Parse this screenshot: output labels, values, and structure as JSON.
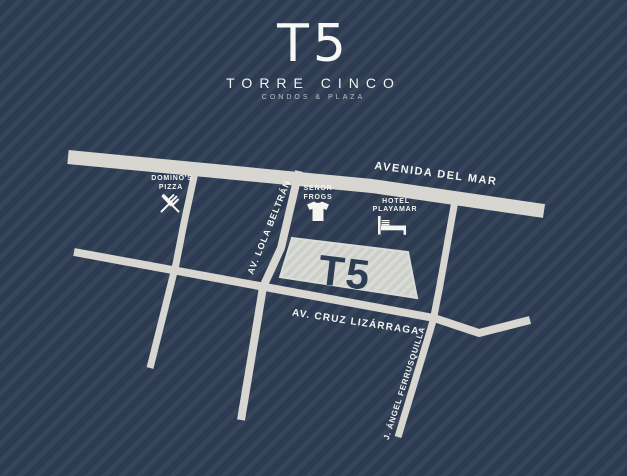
{
  "logo": {
    "mark": "T5",
    "name": "TORRE CINCO",
    "tagline": "CONDOS & PLAZA"
  },
  "map": {
    "building": {
      "label": "T5"
    },
    "streets": {
      "avenida_del_mar": "AVENIDA DEL MAR",
      "lola_beltran": "AV. LOLA BELTRÁN",
      "cruz_lizarraga": "AV. CRUZ LIZÁRRAGA",
      "ferrusquilla": "J. ÁNGEL FERRUSQUILLA"
    },
    "landmarks": {
      "dominos": {
        "line1": "DOMINO'S",
        "line2": "PIZZA",
        "icon": "crossed-cutlery-icon"
      },
      "senor_frogs": {
        "line1": "SEÑOR",
        "line2": "FROGS",
        "icon": "tshirt-icon"
      },
      "hotel_playamar": {
        "line1": "HOTEL",
        "line2": "PLAYAMAR",
        "icon": "bed-icon"
      }
    },
    "colors": {
      "background": "#2c3b51",
      "background_stripe": "#344459",
      "street": "#d7d6d1",
      "building_fill": "#cdcfca",
      "building_hatch": "#dadbd6",
      "label_text": "#f4f4f1",
      "building_text": "#2d3c52"
    }
  }
}
